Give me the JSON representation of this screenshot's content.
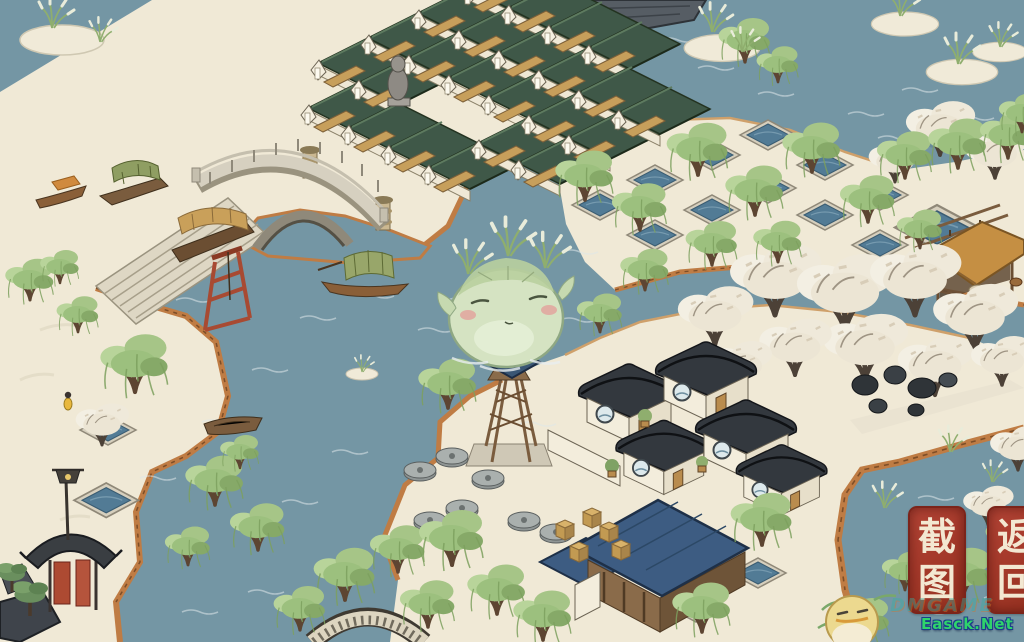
{
  "ui": {
    "screenshot_button": {
      "label": "截图",
      "chars": [
        "截",
        "图"
      ]
    },
    "back_button": {
      "label": "返回",
      "chars": [
        "返",
        "回"
      ]
    },
    "watermark": "Easck.Net",
    "faint_watermark": "DMGAME"
  },
  "colors": {
    "water": "#7496a4",
    "land": "#f0e9d6",
    "cliff": "#bf7c44",
    "shop_roof_green": "#3f5848",
    "house_roof_dark": "#33383e",
    "mill_roof_blue": "#3d5c82",
    "willow_green": "#a6c587",
    "blossom_white": "#f3efe3",
    "seal_button_red": "#a93a2c",
    "seal_button_text": "#f3e8d2",
    "watermark_green": "#2fd36b",
    "watermark_outline": "#1b3c8a"
  }
}
